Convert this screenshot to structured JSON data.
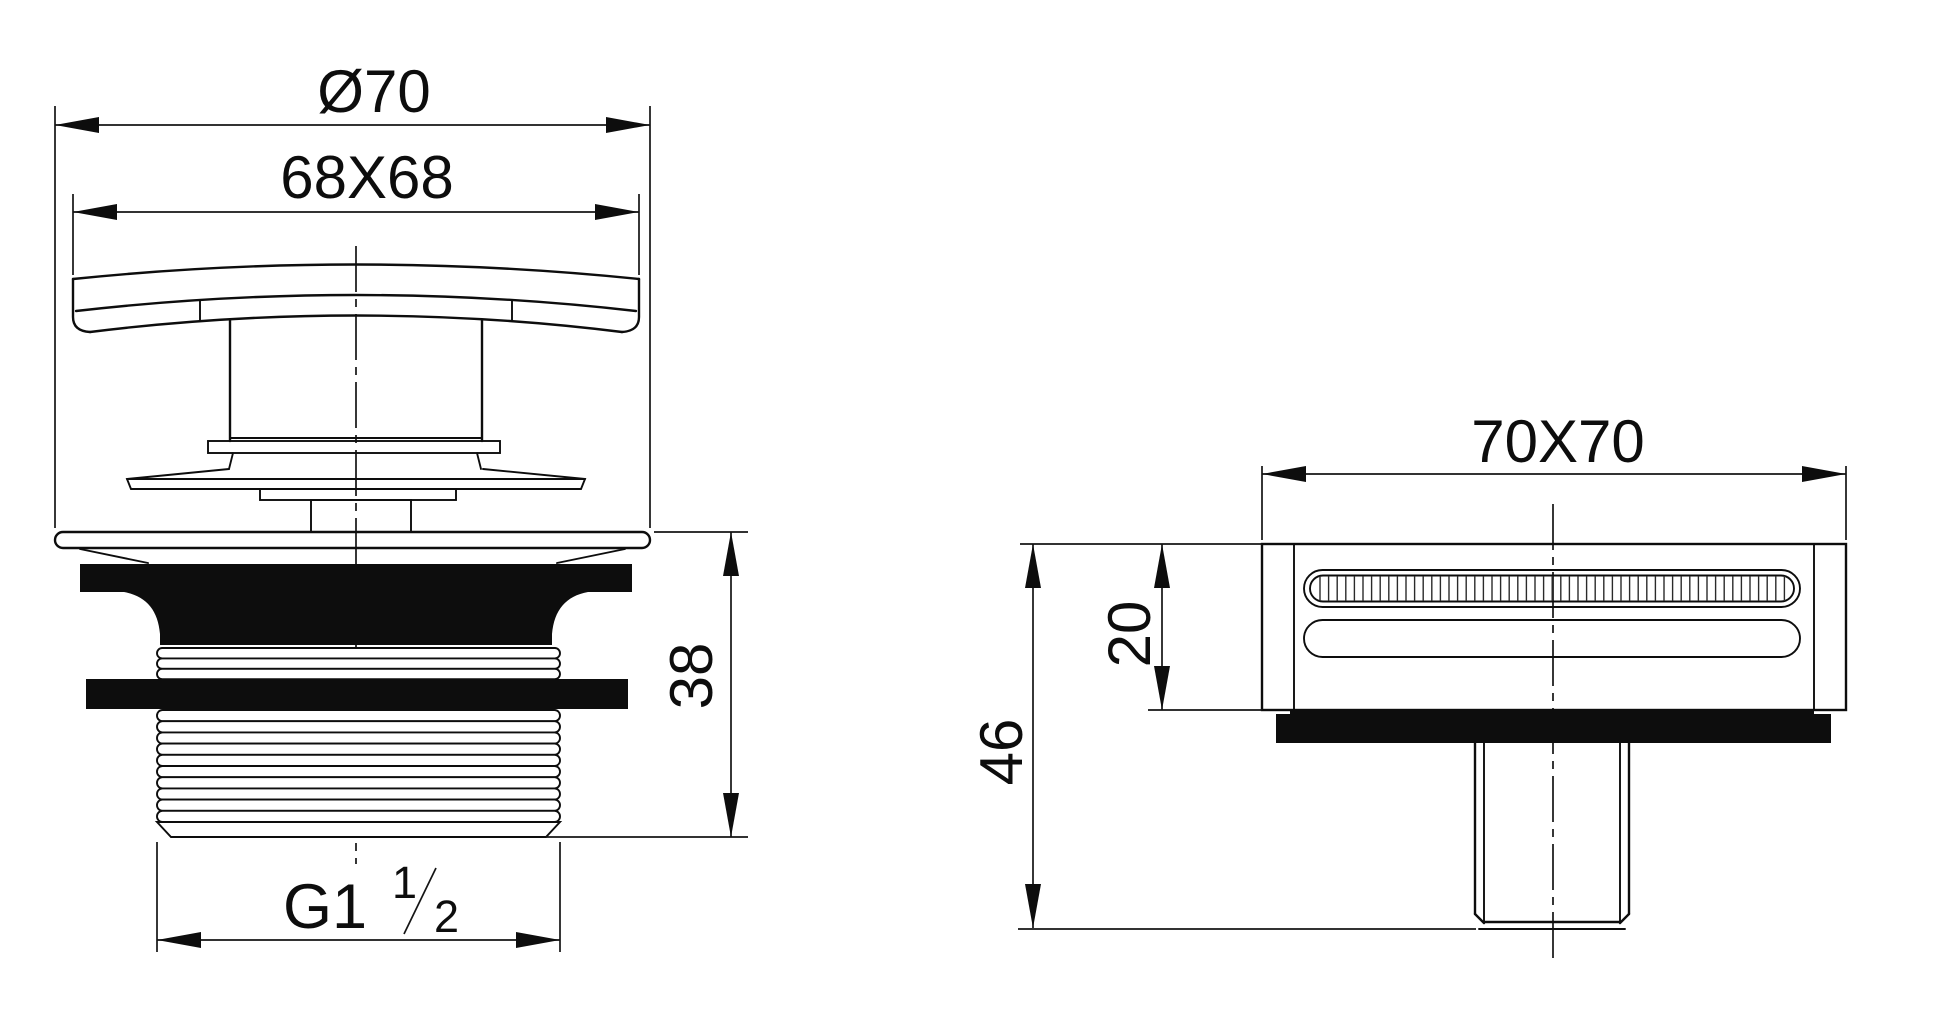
{
  "drawing": {
    "kind": "technical-drawing",
    "subject": "square pop-up drain waste fitting, two orthographic views",
    "line_color": "#0d0d0d",
    "background": "#ffffff",
    "front": {
      "dims": {
        "diameter": "Ø70",
        "cap": "68X68",
        "height": "38",
        "thread_main": "G1",
        "thread_sup": "1",
        "thread_sub": "2"
      }
    },
    "side": {
      "dims": {
        "width": "70X70",
        "inner_height": "20",
        "total_height": "46"
      }
    }
  }
}
